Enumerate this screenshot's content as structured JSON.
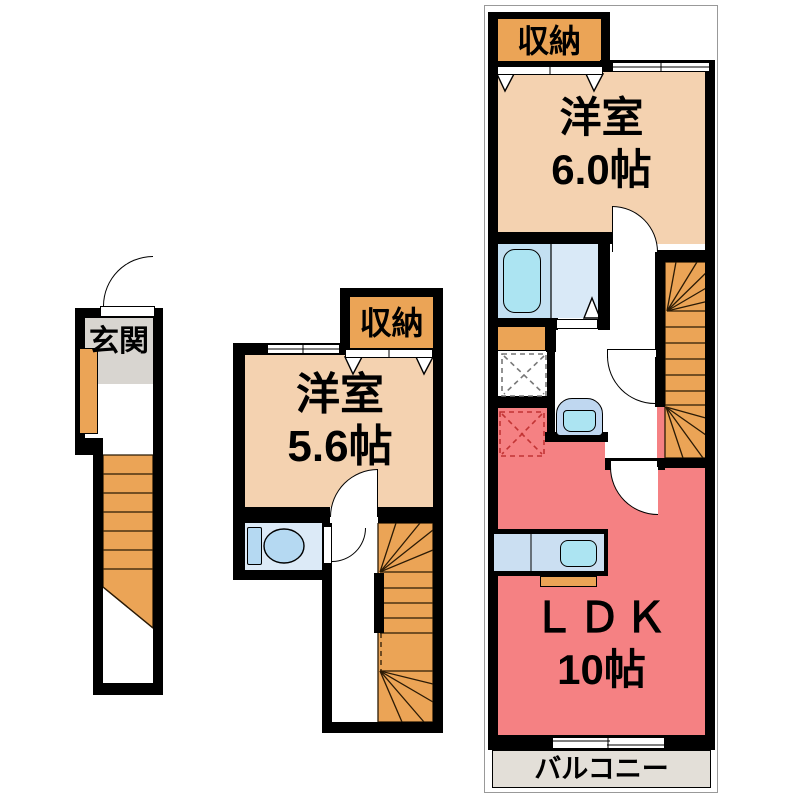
{
  "title": "3-story maisonette floor plan",
  "colors": {
    "wall": "#000000",
    "peach": "#F4D2B0",
    "orange": "#EBA456",
    "pink": "#F58183",
    "bath": "#C3E0F2",
    "bathtub": "#ACE4F2",
    "washroom": "#D9E9F7",
    "toilet-room": "#DCEAF7",
    "fixture-blue": "#B5D9F2",
    "counter-blue": "#CBDFF2",
    "sink-blue": "#ACE4F2",
    "basin-blue": "#BFD7F0",
    "floor-gray": "#D8D5D0",
    "balcony": "#E3DFD8"
  },
  "left_plan": {
    "entrance_label": "玄関"
  },
  "middle_plan": {
    "storage_label": "収納",
    "room_label": "洋室",
    "room_size": "5.6帖"
  },
  "right_plan": {
    "storage_label": "収納",
    "room_label": "洋室",
    "room_size": "6.0帖",
    "ldk_label": "ＬＤＫ",
    "ldk_size": "10帖",
    "balcony_label": "バルコニー"
  }
}
